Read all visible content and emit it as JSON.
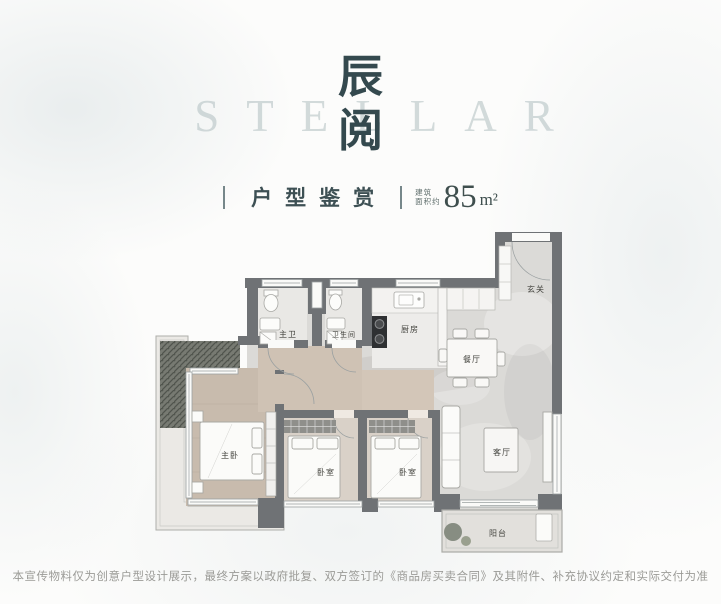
{
  "watermark": "STELLAR",
  "title": {
    "char1": "辰",
    "char2": "阅"
  },
  "subtitle": {
    "label": "户型鉴赏"
  },
  "area": {
    "prefix_line1": "建筑",
    "prefix_line2": "面积约",
    "value": "85",
    "unit": "m²"
  },
  "floorplan": {
    "rooms": {
      "master_bedroom": "主卧",
      "bedroom_a": "卧室",
      "bedroom_b": "卧室",
      "living": "客厅",
      "dining": "餐厅",
      "kitchen": "厨房",
      "master_bath": "主卫",
      "bath": "卫生间",
      "foyer": "玄关",
      "balcony": "阳台"
    }
  },
  "disclaimer": "本宣传物料仅为创意户型设计展示，最终方案以政府批复、双方签订的《商品房买卖合同》及其附件、补充协议约定和实际交付为准",
  "colors": {
    "title": "#34494e",
    "watermark": "#aebdc0",
    "wall": "#6f7275",
    "wood_floor": "#c8bbad",
    "marble_floor": "#dbdad7",
    "hedge": "#777a72"
  }
}
